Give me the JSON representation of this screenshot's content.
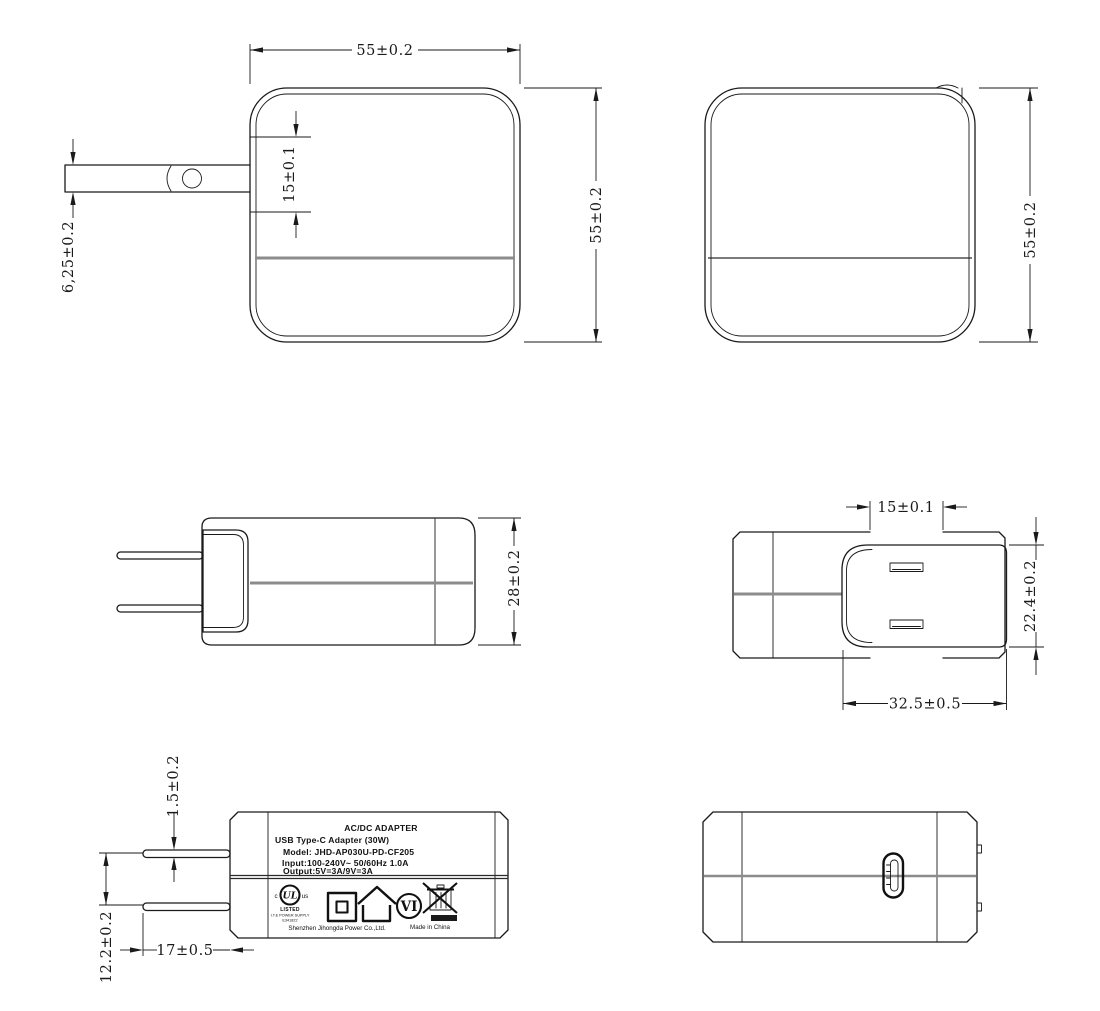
{
  "dims": {
    "front_width": "55±0.2",
    "front_height": "55±0.2",
    "front_notch": "15±0.1",
    "blade_offset": "6,25±0.2",
    "rear_height": "55±0.2",
    "side_depth": "28±0.2",
    "plug_notch": "15±0.1",
    "plug_base_height": "22.4±0.2",
    "plug_base_width": "32.5±0.5",
    "prong_thickness": "1.5±0.2",
    "prong_gap": "12.2±0.2",
    "prong_length": "17±0.5"
  },
  "label": {
    "heading": "AC/DC  ADAPTER",
    "subheading": "USB Type-C Adapter   (30W)",
    "model": "Model: JHD-AP030U-PD-CF205",
    "input": "Input:100-240V~  50/60Hz  1.0A",
    "output": "Output:5V=3A/9V=3A",
    "ul_c": "c",
    "ul_mark": "UL",
    "ul_us": "us",
    "ul_listed": "LISTED",
    "ul_category": "I.T.E POWER SUPPLY",
    "ul_file": "E341822",
    "efficiency_mark": "VI",
    "manufacturer": "Shenzhen Jihongda Power Co.,Ltd.",
    "origin": "Made in China"
  },
  "colors": {
    "line": "#1a1a1a",
    "seam": "#8c8c8c"
  }
}
